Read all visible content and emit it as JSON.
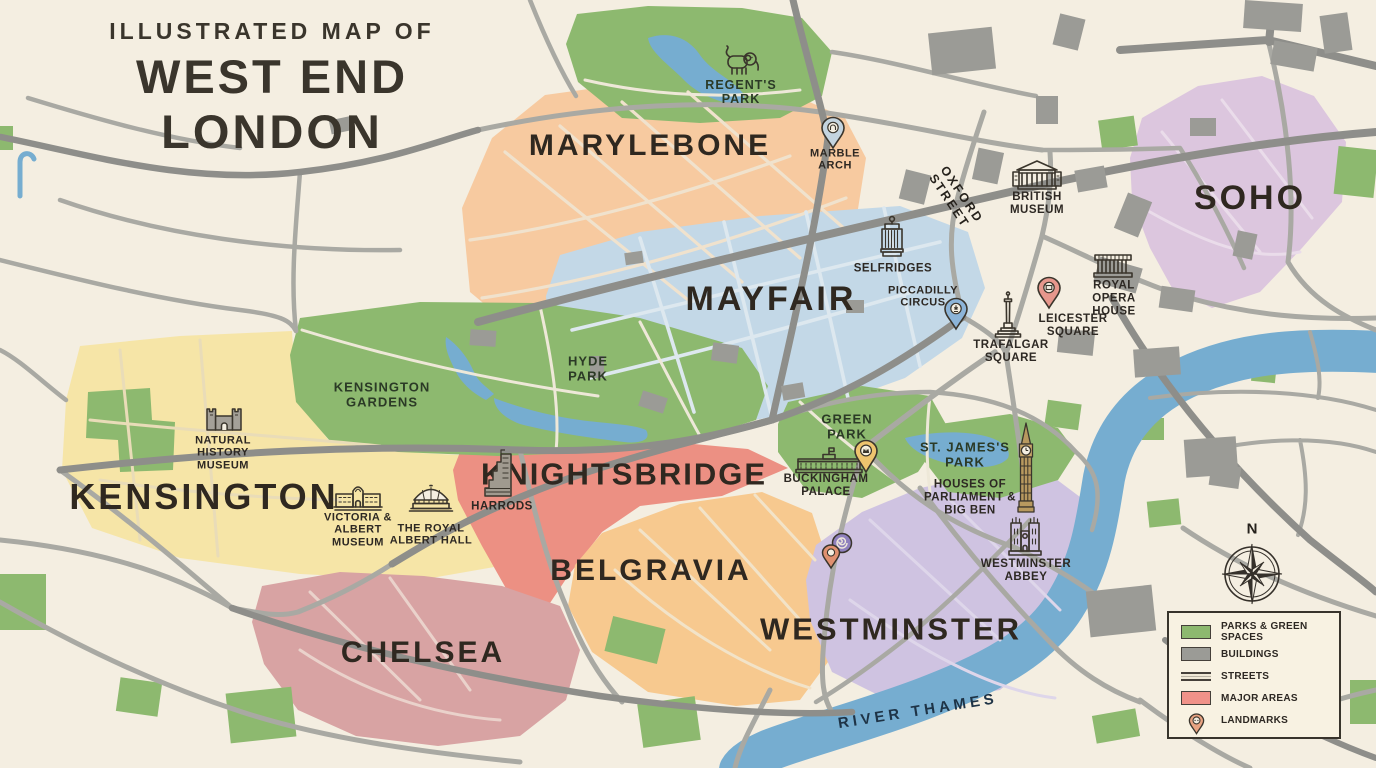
{
  "title": {
    "kicker": "ILLUSTRATED MAP OF",
    "name": "WEST END LONDON"
  },
  "areas": {
    "marylebone": "MARYLEBONE",
    "mayfair": "MAYFAIR",
    "soho": "SOHO",
    "kensington": "KENSINGTON",
    "knightsbridge": "KNIGHTSBRIDGE",
    "belgravia": "BELGRAVIA",
    "chelsea": "CHELSEA",
    "westminster": "WESTMINSTER"
  },
  "parks": {
    "regents": "REGENT'S PARK",
    "kensington_gardens": "KENSINGTON GARDENS",
    "hyde": "HYDE PARK",
    "green": "GREEN PARK",
    "st_james": "ST. JAMES'S PARK"
  },
  "landmarks": {
    "marble_arch": "MARBLE ARCH",
    "british_museum": "BRITISH MUSEUM",
    "selfridges": "SELFRIDGES",
    "piccadilly": "PICCADILLY CIRCUS",
    "royal_opera": "ROYAL OPERA HOUSE",
    "leicester": "LEICESTER SQUARE",
    "trafalgar": "TRAFALGAR SQUARE",
    "nhm": "NATURAL HISTORY MUSEUM",
    "va": "VICTORIA & ALBERT MUSEUM",
    "albert_hall": "THE ROYAL ALBERT HALL",
    "harrods": "HARRODS",
    "buckingham": "BUCKINGHAM PALACE",
    "parliament": "HOUSES OF PARLIAMENT & BIG BEN",
    "abbey": "WESTMINSTER ABBEY"
  },
  "streets": {
    "oxford": "OXFORD STREET"
  },
  "river": {
    "name": "RIVER THAMES"
  },
  "compass": {
    "north": "N"
  },
  "legend": {
    "parks": "PARKS & GREEN SPACES",
    "buildings": "BUILDINGS",
    "streets": "STREETS",
    "major_areas": "MAJOR AREAS",
    "landmarks": "LANDMARKS"
  },
  "colors": {
    "background": "#f4eee1",
    "park": "#8db96f",
    "water": "#76add0",
    "road_major": "#8e8e8a",
    "road_minor": "#a9a9a3",
    "building": "#9b9b96",
    "marylebone": "#f7caa0",
    "mayfair": "#c3d8e7",
    "soho": "#dcc6de",
    "kensington": "#f6e5a7",
    "knightsbridge": "#ec9083",
    "belgravia": "#f7c98f",
    "chelsea": "#d8a3a3",
    "westminster": "#cfc3e1",
    "legend_red": "#f09289",
    "ink": "#3a352c"
  }
}
